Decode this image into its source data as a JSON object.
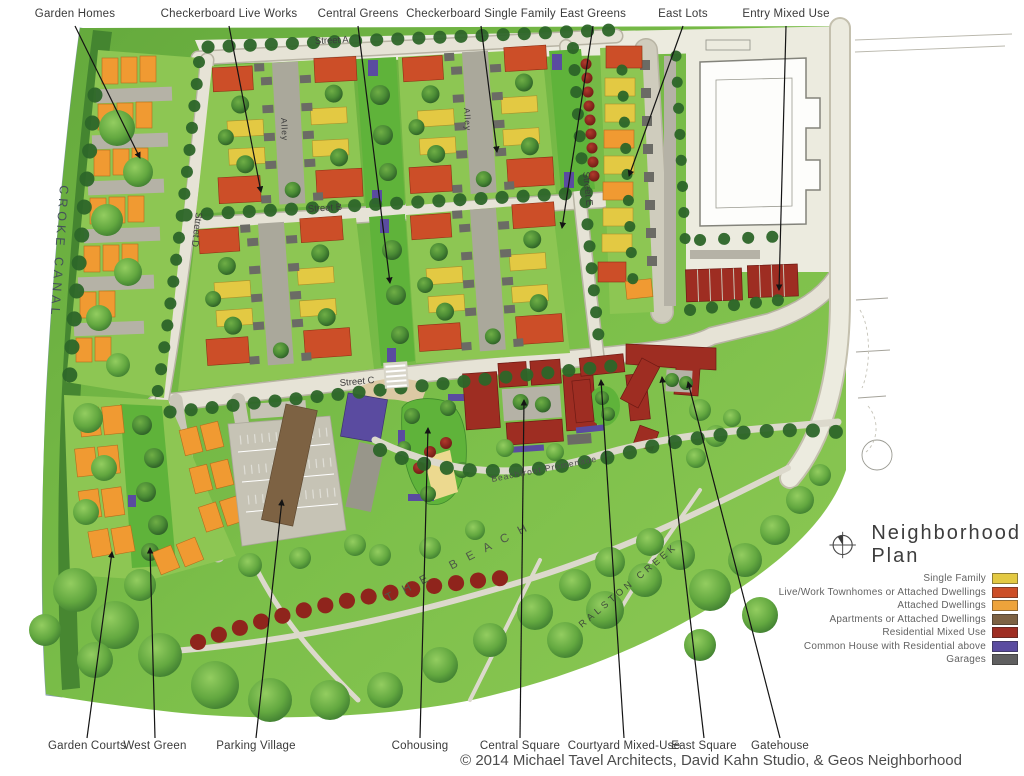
{
  "title": "Neighborhood Plan",
  "copyright": "© 2014 Michael Tavel Architects, David Kahn Studio, & Geos Neighborhood",
  "callouts_top": [
    "Garden Homes",
    "Checkerboard Live Works",
    "Central Greens",
    "Checkerboard Single Family",
    "East Greens",
    "East Lots",
    "Entry Mixed Use"
  ],
  "callouts_bottom": [
    "Garden Courts",
    "West Green",
    "Parking Village",
    "Cohousing",
    "Central Square",
    "Courtyard Mixed-Use",
    "East Square",
    "Gatehouse"
  ],
  "map_labels": {
    "street_a": "Street A",
    "street_b": "Street B",
    "street_c": "Street C",
    "street_d": "Street D",
    "street_e": "Street E",
    "alley_west": "Alley",
    "alley_east": "Alley",
    "croke_canal": "CROKE CANAL",
    "the_beach": "THE BEACH",
    "ralston_creek": "RALSTON CREEK",
    "beachfront_promenade": "Beachfront Promenade"
  },
  "legend": {
    "items": [
      {
        "label": "Single Family",
        "color": "#e3c943"
      },
      {
        "label": "Live/Work Townhomes or Attached Dwellings",
        "color": "#cc4e28"
      },
      {
        "label": "Attached Dwellings",
        "color": "#eda33b"
      },
      {
        "label": "Apartments or Attached Dwellings",
        "color": "#7d6243"
      },
      {
        "label": "Residential Mixed Use",
        "color": "#9e2d22"
      },
      {
        "label": "Common House with Residential above",
        "color": "#5a4ba0"
      },
      {
        "label": "Garages",
        "color": "#5f5f60"
      }
    ]
  },
  "icons": {
    "compass": "north-compass"
  }
}
